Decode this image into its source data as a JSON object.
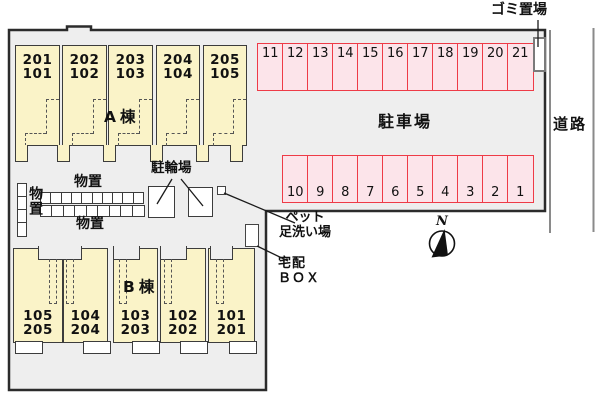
{
  "colors": {
    "site_fill": "#eeeeee",
    "boundary": "#2b2b2b",
    "building_fill": "#faf3c8",
    "building_border": "#3c3c3c",
    "parking_fill": "#fce4ea",
    "parking_border": "#ee3b47",
    "road_line": "#8a8a8a",
    "leader_line": "#1a1a1a"
  },
  "labels": {
    "garbage_area": "ゴミ置場",
    "road": "道路",
    "parking_lot": "駐車場",
    "bicycle_parking": "駐輪場",
    "storage_top": "物置",
    "storage_bottom": "物置",
    "storage_left": "物置",
    "pet_wash": "ペット\n足洗い場",
    "delivery_box": "宅配\nＢＯＸ",
    "north": "N",
    "building_a": "A棟",
    "building_b": "B棟"
  },
  "buildings": {
    "a": {
      "name": "A棟",
      "units": [
        {
          "text": "201\n101"
        },
        {
          "text": "202\n102"
        },
        {
          "text": "203\n103"
        },
        {
          "text": "204\n104"
        },
        {
          "text": "205\n105"
        }
      ]
    },
    "b": {
      "name": "B棟",
      "units": [
        {
          "text": "105\n205"
        },
        {
          "text": "104\n204"
        },
        {
          "text": "103\n203"
        },
        {
          "text": "102\n202"
        },
        {
          "text": "101\n201"
        }
      ]
    }
  },
  "parking": {
    "top_row": [
      "11",
      "12",
      "13",
      "14",
      "15",
      "16",
      "17",
      "18",
      "19",
      "20",
      "21"
    ],
    "bottom_row": [
      "10",
      "9",
      "8",
      "7",
      "6",
      "5",
      "4",
      "3",
      "2",
      "1"
    ]
  },
  "storage": {
    "top_row_cells": 10,
    "bottom_row_cells": 9,
    "left_column_cells": 4
  }
}
